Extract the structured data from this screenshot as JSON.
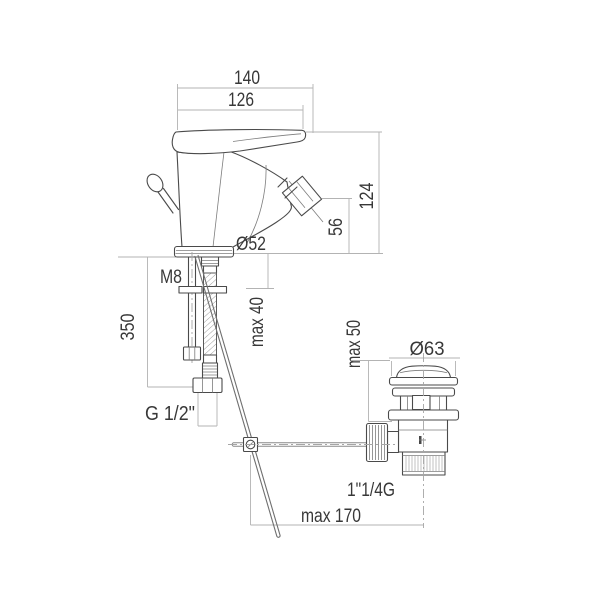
{
  "drawing": {
    "subject": "single-lever bidet mixer with pop-up waste - dimensional technical drawing",
    "background": "#ffffff",
    "outline_color": "#4a4a4a",
    "dimension_line_color": "#b3b3b3",
    "text_color": "#383838",
    "labels": {
      "width_overall": "140",
      "width_body": "126",
      "height_overall": "124",
      "height_spout": "56",
      "base_diameter": "Ø52",
      "stud_thread": "M8",
      "hose_length": "350",
      "deck_thickness": "max 40",
      "hose_thread": "G 1/2\"",
      "drain_deck_thickness": "max 50",
      "drain_cap_diameter": "Ø63",
      "drain_thread": "1\"1/4G",
      "rod_length": "max 170"
    }
  }
}
